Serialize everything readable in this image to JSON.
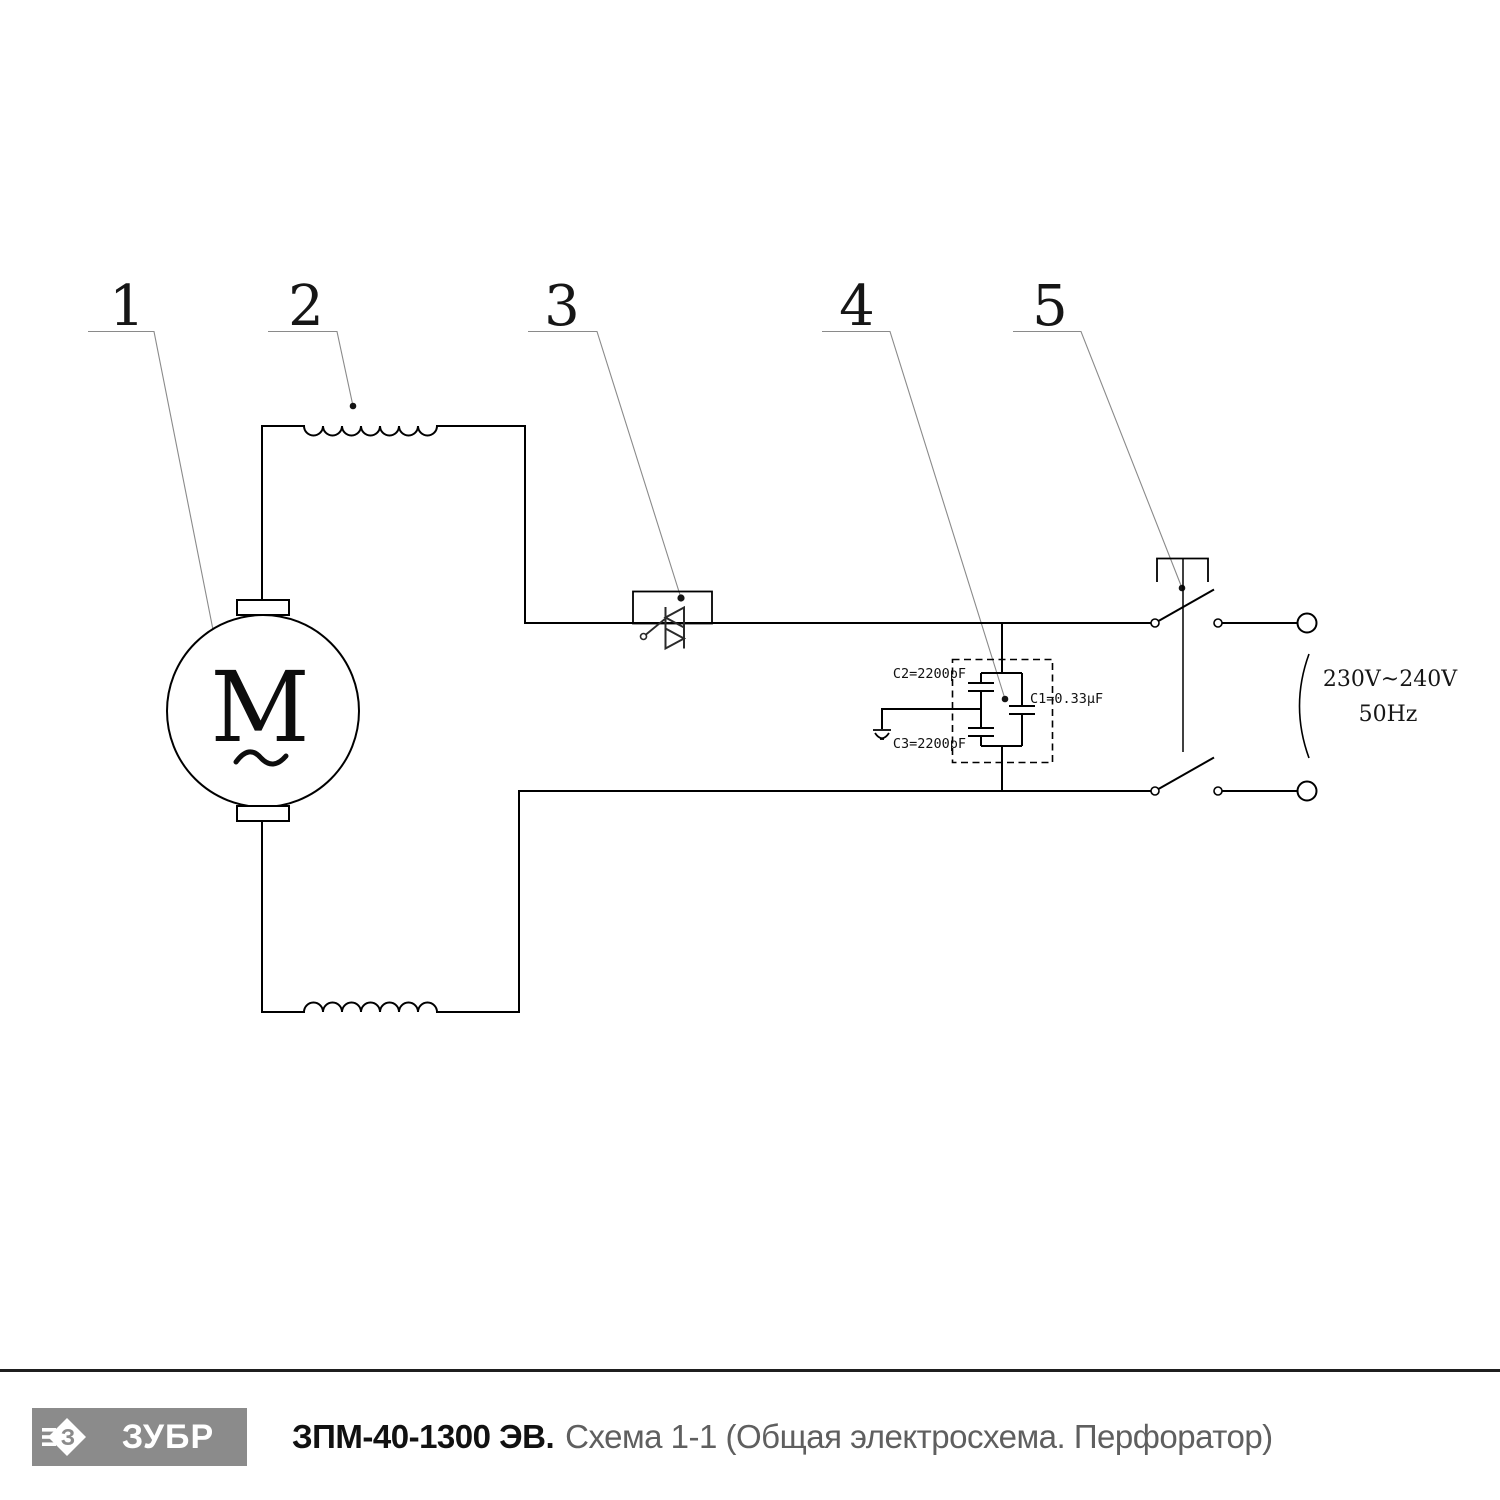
{
  "schematic": {
    "part_labels": [
      "1",
      "2",
      "3",
      "4",
      "5"
    ],
    "motor": {
      "letter": "M"
    },
    "capacitors": {
      "c2_label": "C2=2200pF",
      "c1_label": "C1=0.33µF",
      "c3_label": "C3=2200pF"
    },
    "power": {
      "voltage": "230V~240V",
      "frequency": "50Hz"
    }
  },
  "footer": {
    "logo_letter": "З",
    "logo_text": "ЗУБР",
    "model": "ЗПМ-40-1300 ЭВ.",
    "subtitle": "Схема 1-1 (Общая электросхема. Перфоратор)"
  },
  "colors": {
    "ink": "#000000",
    "leader": "#8a8a8a",
    "logo_box": "#8b8b8b",
    "subtitle": "#5f5f5f",
    "rule": "#1f1f1f"
  }
}
